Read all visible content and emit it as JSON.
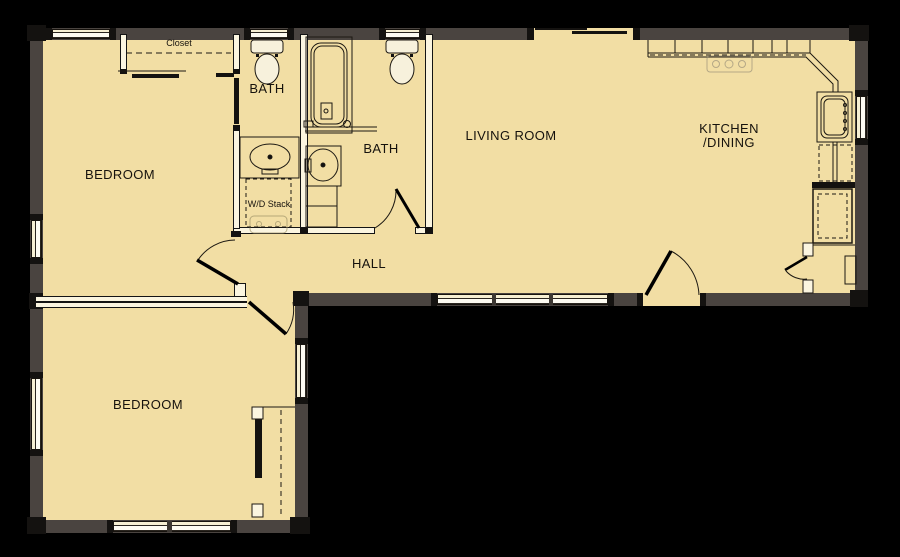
{
  "title": "Apartment floor plan",
  "colors": {
    "background": "#000000",
    "floor": "#F2DEA4",
    "exterior_wall": "#4A4440",
    "interior_wall_fill": "#FBF5E0",
    "window_fill": "#F6EFD3",
    "line": "#141414"
  },
  "rooms": [
    {
      "id": "bedroom-1",
      "label": "BEDROOM"
    },
    {
      "id": "bath-1",
      "label": "BATH"
    },
    {
      "id": "bath-2",
      "label": "BATH"
    },
    {
      "id": "living-room",
      "label": "LIVING ROOM"
    },
    {
      "id": "kitchen-dining",
      "label_line1": "KITCHEN",
      "label_line2": "/DINING"
    },
    {
      "id": "hall",
      "label": "HALL"
    },
    {
      "id": "bedroom-2",
      "label": "BEDROOM"
    }
  ],
  "annotations": [
    {
      "id": "closet",
      "label": "Closet"
    },
    {
      "id": "wd-stack",
      "label": "W/D Stack"
    }
  ]
}
